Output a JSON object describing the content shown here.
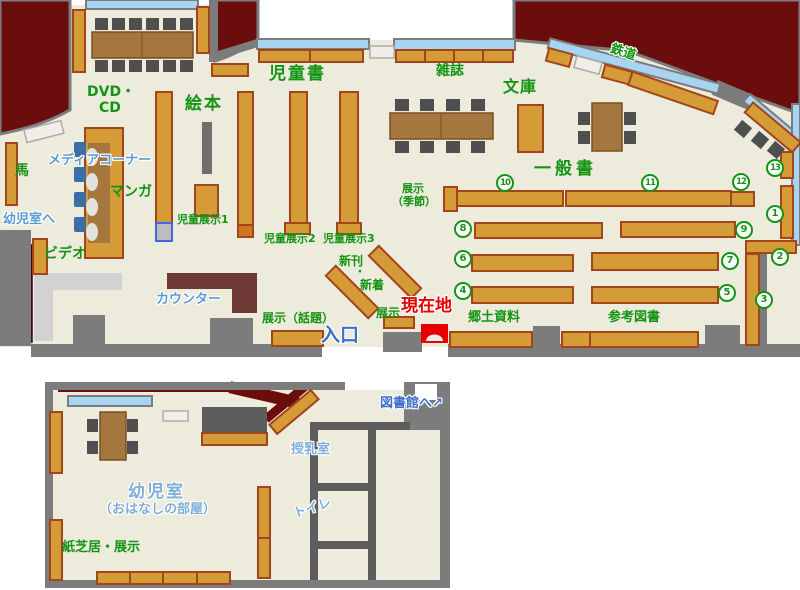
{
  "labels": {
    "children_books": "児童書",
    "picture_books": "絵本",
    "dvd_line1": "DVD・",
    "dvd_line2": "CD",
    "magazines": "雑誌",
    "bunko": "文庫",
    "railway": "鉄道",
    "general_books": "一般書",
    "media_corner": "メディアコーナー",
    "manga": "マンガ",
    "horse": "馬",
    "to_infant_room": "幼児室へ",
    "video": "ビデオ",
    "counter": "カウンター",
    "child_exhibit1": "児童展示1",
    "child_exhibit2": "児童展示2",
    "child_exhibit3": "児童展示3",
    "new_arrivals_line1": "新刊",
    "new_arrivals_dot": "・",
    "new_arrivals_line2": "新着",
    "exhibit_topics": "展示（話題）",
    "entrance": "入口",
    "exhibit": "展示",
    "current_location": "現在地",
    "exhibit_season_line1": "展示",
    "exhibit_season_line2": "（季節）",
    "local_materials": "郷土資料",
    "reference_books": "参考図書",
    "infant_room": "幼児室",
    "storytelling_room": "（おはなしの部屋）",
    "kamishibai_exhibit": "紙芝居・展示",
    "nursing_room": "授乳室",
    "toilet": "トイレ",
    "to_library": "図書館へ",
    "to_library_arrow": "↗"
  },
  "shelf_numbers": [
    "1",
    "2",
    "3",
    "4",
    "5",
    "6",
    "7",
    "8",
    "9",
    "10",
    "11",
    "12",
    "13"
  ],
  "legend_colors": {
    "floor": "#EDEBDB",
    "outside_dark_red": "#6C0D0D",
    "wall_gray": "#7C7C7C",
    "bookshelf_orange": "#D59B36",
    "bookshelf_border": "#A2451B",
    "table_brown": "#A5763E",
    "chair_gray": "#4F4F4F",
    "chair_blue": "#3D6FA6",
    "window_blue": "#A8D4F2",
    "counter_maroon": "#6F3A36",
    "staff_desk_gray": "#D2D2D2",
    "label_green": "#149414",
    "label_blue": "#5B9BD5",
    "entrance_blue": "#3E6FCB",
    "current_location_red": "#E60000"
  }
}
